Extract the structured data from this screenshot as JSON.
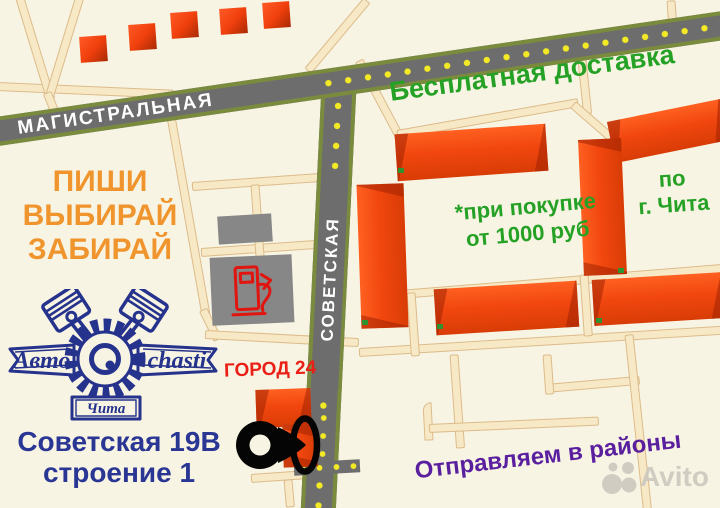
{
  "map": {
    "streets": {
      "horizontal": "МАГИСТРАЛЬНАЯ",
      "vertical": "СОВЕТСКАЯ"
    },
    "promo": {
      "free_delivery": "Бесплатная доставка",
      "condition": [
        "*при покупке",
        "от 1000 руб"
      ],
      "area": [
        "по",
        "г. Чита"
      ],
      "districts": "Отправляем в районы"
    },
    "cta": [
      "ПИШИ",
      "ВЫБИРАЙ",
      "ЗАБИРАЙ"
    ],
    "store": {
      "name": "ГОРОД 24",
      "address": [
        "Советская 19В",
        "строение 1"
      ]
    },
    "logo": {
      "left": "Авто",
      "right": "chasti",
      "city": "Чита"
    },
    "watermark": "Avito",
    "icons": [
      "gas-station-icon",
      "location-pin-icon",
      "circle-highlight-icon",
      "gear-icon",
      "piston-icon",
      "avito-dots-icon"
    ],
    "colors": {
      "background": "#f8f4e4",
      "minor_road": "#f7e9c6",
      "minor_road_edge": "#dcbb8a",
      "major_road": "#6d6d6d",
      "road_edge_green": "#7a8b3e",
      "road_dot_yellow": "#f3ea25",
      "building_orange": "#f1470f",
      "lot_gray": "#878787",
      "text_green": "#25a125",
      "text_orange": "#f0952d",
      "text_navy": "#2a3694",
      "text_red": "#ea1f16",
      "text_purple": "#5a1f9e",
      "gas_pump_red": "#e01510",
      "watermark_gray": "#cdc9c0"
    }
  }
}
